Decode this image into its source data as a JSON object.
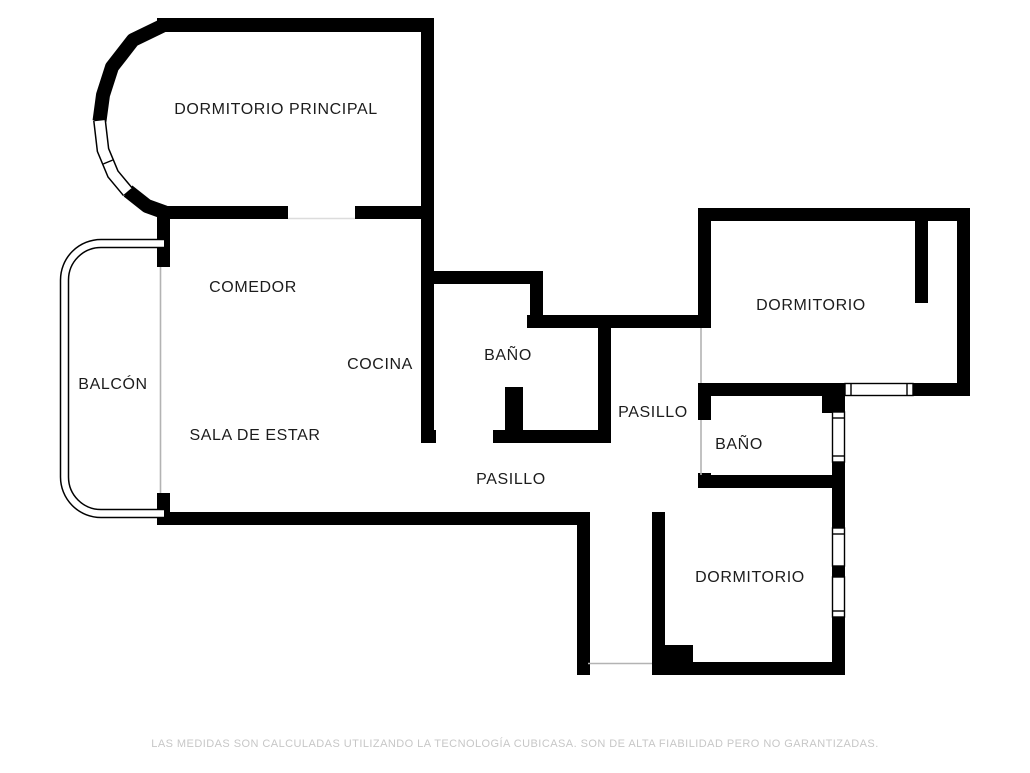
{
  "rooms": [
    {
      "id": "dormitorio-principal",
      "label": "DORMITORIO PRINCIPAL"
    },
    {
      "id": "comedor",
      "label": "COMEDOR"
    },
    {
      "id": "cocina",
      "label": "COCINA"
    },
    {
      "id": "bano-1",
      "label": "BAÑO"
    },
    {
      "id": "pasillo-1",
      "label": "PASILLO"
    },
    {
      "id": "sala-de-estar",
      "label": "SALA DE ESTAR"
    },
    {
      "id": "balcon",
      "label": "BALCÓN"
    },
    {
      "id": "dormitorio-2",
      "label": "DORMITORIO"
    },
    {
      "id": "bano-2",
      "label": "BAÑO"
    },
    {
      "id": "pasillo-2",
      "label": "PASILLO"
    },
    {
      "id": "dormitorio-3",
      "label": "DORMITORIO"
    }
  ],
  "footer": {
    "disclaimer": "LAS MEDIDAS SON CALCULADAS UTILIZANDO LA TECNOLOGÍA CUBICASA. SON DE ALTA FIABILIDAD PERO NO GARANTIZADAS."
  },
  "colors": {
    "wall": "#000000",
    "background": "#ffffff",
    "label_text": "#1c1c1c",
    "footer_text": "#c7c7c7",
    "door_line": "#b3b3b3"
  }
}
